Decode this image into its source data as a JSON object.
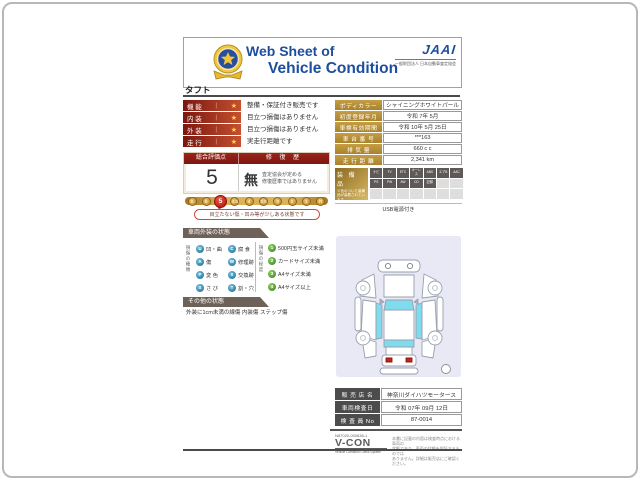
{
  "colors": {
    "brand_blue": "#1d4e9e",
    "accent_red": "#8c1e14",
    "gold": "#b8923c",
    "teal_code": "#2a7fa6",
    "green_code": "#4e8f2a",
    "banner_gray": "#6e6158"
  },
  "header": {
    "title_line1": "Web Sheet of",
    "title_line2": "Vehicle Condition",
    "jaai_logo": "JAAI",
    "jaai_subtitle": "一般財団法人 日本自動車査定協会"
  },
  "vehicle_name": "タフト",
  "condition_rows": [
    {
      "label": "機 能",
      "pipe": "|",
      "star": "★",
      "text": "整備・保証付き販売です"
    },
    {
      "label": "内 装",
      "pipe": "|",
      "star": "★",
      "text": "目立つ損傷はありません"
    },
    {
      "label": "外 装",
      "pipe": "|",
      "star": "★",
      "text": "目立つ損傷はありません"
    },
    {
      "label": "走 行",
      "pipe": "|",
      "star": "★",
      "text": "実走行距離です"
    }
  ],
  "evaluation": {
    "header_left": "総合評価点",
    "header_right": "修 復 歴",
    "score": "5",
    "repair_mark": "無",
    "repair_note_line1": "査定協会が定める",
    "repair_note_line2": "修復歴車ではありません",
    "scale": [
      "S",
      "6",
      "5",
      "4.5",
      "4",
      "3.5",
      "3",
      "2",
      "1",
      "R"
    ],
    "scale_selected": "5",
    "scale_note": "目立たない傷・凹み等が少しある状態です"
  },
  "exterior_section": {
    "title": "車両外装の状態",
    "damage_type_label": "損傷の種類",
    "damage_types": [
      {
        "code": "U",
        "label": "凹・曲"
      },
      {
        "code": "C",
        "label": "腐 食"
      },
      {
        "code": "A",
        "label": "傷"
      },
      {
        "code": "W",
        "label": "修理跡"
      },
      {
        "code": "P",
        "label": "変 色"
      },
      {
        "code": "X",
        "label": "交換跡"
      },
      {
        "code": "S",
        "label": "さ び"
      },
      {
        "code": "T",
        "label": "割・穴"
      }
    ],
    "damage_degree_label": "損傷の程度",
    "damage_degrees": [
      {
        "code": "1",
        "label": "500円玉サイズ未満"
      },
      {
        "code": "2",
        "label": "カードサイズ未満"
      },
      {
        "code": "3",
        "label": "A4サイズ未満"
      },
      {
        "code": "4",
        "label": "A4サイズ以上"
      }
    ]
  },
  "other_section": {
    "title": "その他の状態",
    "text": "外装に1cm未満の線傷 内装傷 ステップ傷"
  },
  "vehicle_info": {
    "rows": [
      {
        "label": "ボディカラー",
        "value": "シャイニングホワイトパール"
      },
      {
        "label": "初度登録年月",
        "value": "令和 7年 5月"
      },
      {
        "label": "車検有効期間",
        "value": "令和 10年 5月 25日"
      },
      {
        "label": "車 台 番 号",
        "value": "***163"
      },
      {
        "label": "排 気 量",
        "value": "660 c c"
      },
      {
        "label": "走 行 距 離",
        "value": "2,341 km"
      }
    ]
  },
  "equipment": {
    "title": "装 備 品",
    "note": "※色のついた装備品が装着されています",
    "badges": [
      "ナビ",
      "TV",
      "ETC",
      "キーレス",
      "ABS",
      "エアB",
      "AAC",
      "PS",
      "PW",
      "AW",
      "CD",
      "記録"
    ],
    "footer": "USB電源付き"
  },
  "dealer": {
    "rows": [
      {
        "label": "販 売 店 名",
        "value": "神奈川ダイハツモータース"
      },
      {
        "label": "車両検査日",
        "value": "令和 07年 09月 12日"
      },
      {
        "label": "検 査 員 No",
        "value": "87-0014"
      }
    ]
  },
  "vcon": {
    "number": "N87020-000838-1",
    "logo": "V-CON",
    "subtitle": "Vehicle Condition Check System",
    "disclaimer_line1": "本書に記載の内容は検査時点における車両の",
    "disclaimer_line2": "状態であり、車両の状態を保証するものでは",
    "disclaimer_line3": "ありません。詳細は販売店にご確認ください。"
  }
}
